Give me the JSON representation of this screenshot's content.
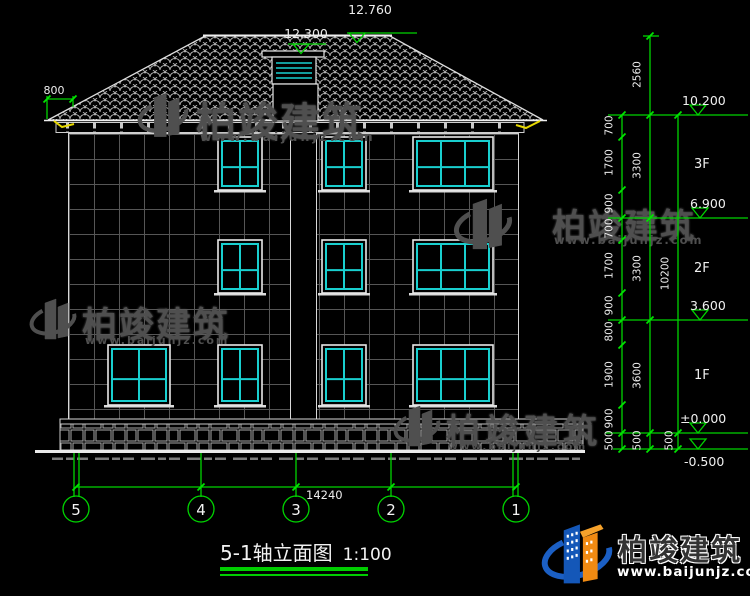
{
  "title": {
    "name": "5-1轴立面图",
    "scale": "1:100"
  },
  "brand": {
    "name": "柏竣建筑",
    "url": "www.baijunjz.com"
  },
  "levels": {
    "ridge": "12.760",
    "chimney": "12.300",
    "eave": "10.200",
    "f3": "6.900",
    "f2": "3.600",
    "f1": "±0.000",
    "ground": "-0.500"
  },
  "floor_labels": [
    "3F",
    "2F",
    "1F"
  ],
  "axes": [
    "5",
    "4",
    "3",
    "2",
    "1"
  ],
  "dims": {
    "overhang": "800",
    "roof_rise": "2560",
    "right_inner": [
      "700",
      "1700",
      "900",
      "700",
      "1700",
      "900",
      "800",
      "1900",
      "900",
      "500"
    ],
    "right_mid": [
      "3300",
      "3300",
      "3600",
      "500"
    ],
    "right_outer": [
      "10200",
      "500"
    ],
    "total_width": "14240"
  },
  "figure": {
    "windows": [
      {
        "x": 218,
        "y": 137,
        "w": 44,
        "h": 53,
        "cols": 2
      },
      {
        "x": 322,
        "y": 137,
        "w": 44,
        "h": 53,
        "cols": 2
      },
      {
        "x": 413,
        "y": 137,
        "w": 80,
        "h": 53,
        "cols": 3
      },
      {
        "x": 218,
        "y": 240,
        "w": 44,
        "h": 53,
        "cols": 2
      },
      {
        "x": 322,
        "y": 240,
        "w": 44,
        "h": 53,
        "cols": 2
      },
      {
        "x": 413,
        "y": 240,
        "w": 80,
        "h": 53,
        "cols": 3
      },
      {
        "x": 108,
        "y": 345,
        "w": 62,
        "h": 60,
        "cols": 2
      },
      {
        "x": 218,
        "y": 345,
        "w": 44,
        "h": 60,
        "cols": 2
      },
      {
        "x": 322,
        "y": 345,
        "w": 44,
        "h": 60,
        "cols": 2
      },
      {
        "x": 413,
        "y": 345,
        "w": 80,
        "h": 60,
        "cols": 3
      }
    ]
  }
}
